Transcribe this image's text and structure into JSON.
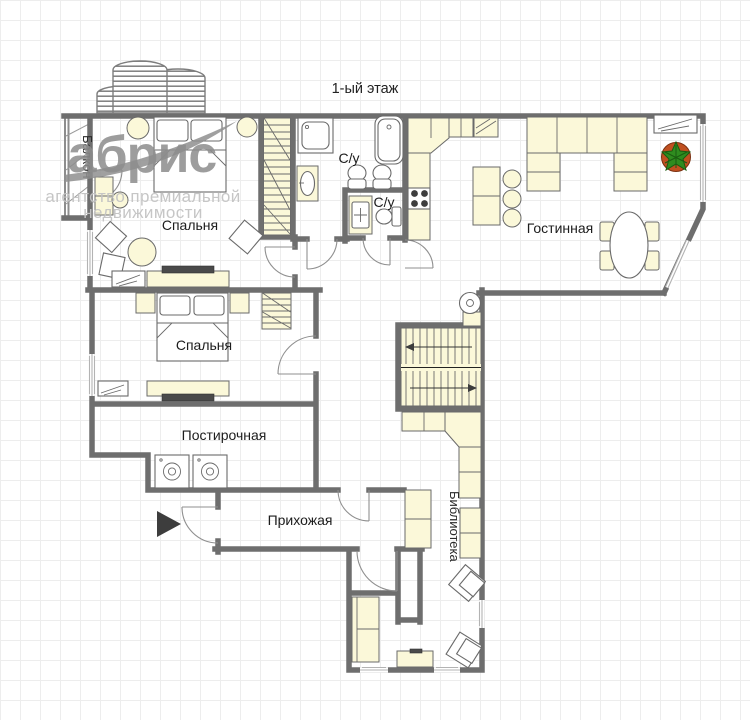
{
  "title": "1-ый этаж",
  "logo": {
    "brand": "абрис",
    "tagline1": "агентство премиальной",
    "tagline2": "недвижимости"
  },
  "rooms": {
    "bedroom1": "Спальня",
    "bedroom2": "Спальня",
    "bathroom1": "С/у",
    "bathroom2": "С/у",
    "living": "Гостинная",
    "laundry": "Постирочная",
    "hallway": "Прихожая",
    "library": "Библиотека",
    "balcony": "Балкон"
  },
  "colors": {
    "wall": "#6e6e6e",
    "furniture_fill": "#FBF8D9",
    "grid_line": "#ededed",
    "logo_gray": "#8d8d8d",
    "tagline_gray": "#c4c4c4",
    "plant_pot": "#C05020",
    "plant_leaves": "#2F8C1F",
    "stove_burner": "#000000",
    "entrance_arrow": "#3d3d3d"
  }
}
